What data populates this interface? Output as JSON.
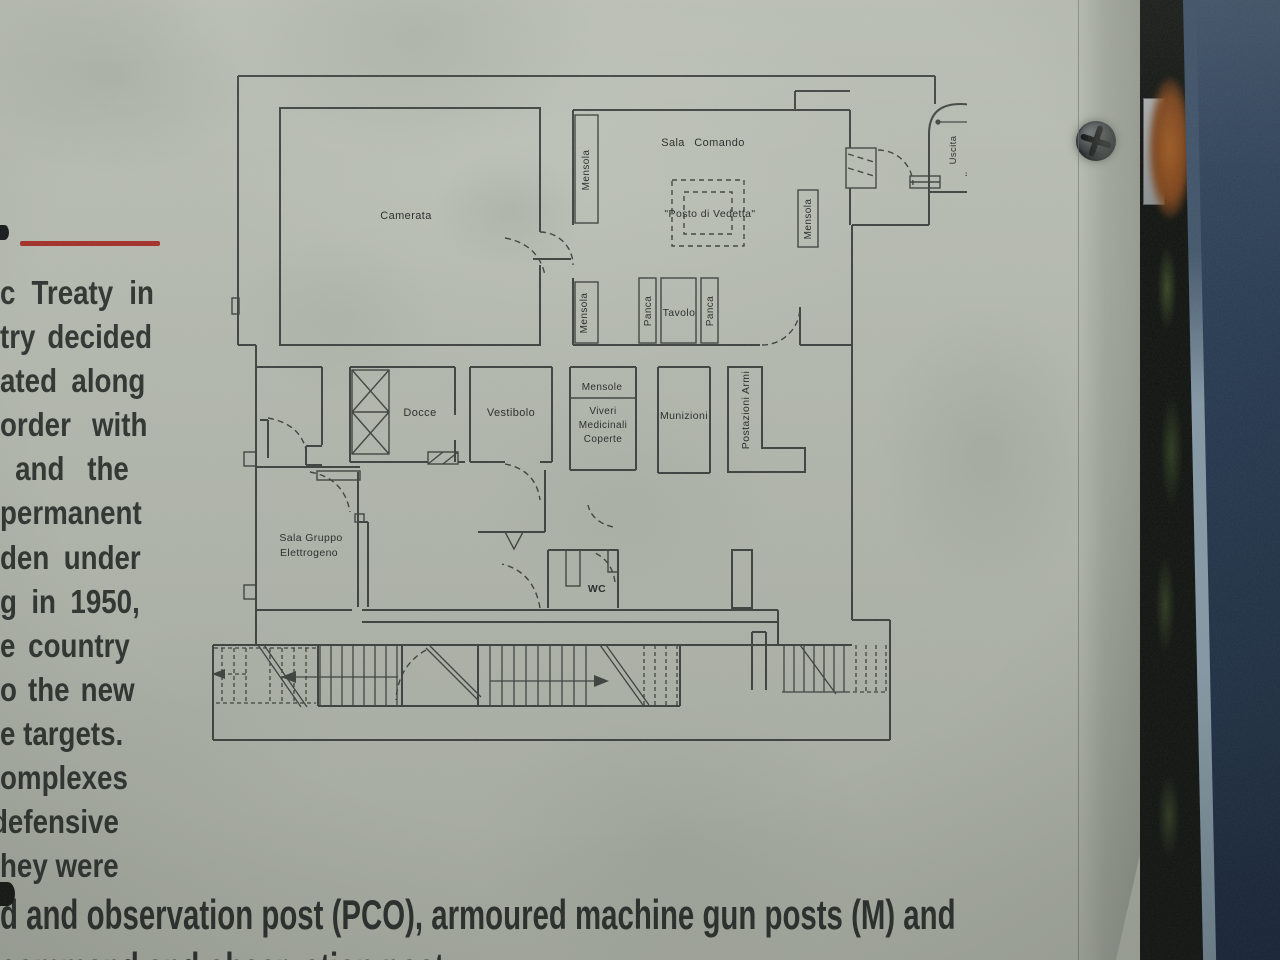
{
  "colors": {
    "panel_concrete": "#b8bdb3",
    "plan_line": "#3f4441",
    "text": "#2f3431",
    "red_rule": "#a62f28",
    "post_blue": "#283c55",
    "rust": "#8a4c1e"
  },
  "left_column": {
    "lines": [
      "c Treaty in",
      "try decided",
      "ated along",
      "order with",
      "and the",
      "permanent",
      "den under",
      "g in 1950,",
      "e country",
      "o the new",
      "e targets.",
      "omplexes",
      "defensive",
      "hey were"
    ]
  },
  "bottom": {
    "line1": "d and observation post (PCO), armoured machine gun posts (M) and",
    "line2": "command and observation post"
  },
  "floorplan": {
    "labels": {
      "camerata": "Camerata",
      "sala_comando": "Sala Comando",
      "posto_di_vedetta": "\"Posto di Vedetta\"",
      "mensola_top": "Mensola",
      "mensola_bottom": "Mensola",
      "mensola_right": "Mensola",
      "panca_left": "Panca",
      "tavolo": "Tavolo",
      "panca_right": "Panca",
      "uscita_line1": "Uscita",
      "uscita_line2": "d'emergenza",
      "docce": "Docce",
      "vestibolo": "Vestibolo",
      "mensole": "Mensole",
      "viveri_line1": "Viveri",
      "viveri_line2": "Medicinali",
      "viveri_line3": "Coperte",
      "munizioni": "Munizioni",
      "postazioni_armi": "Postazioni Armi",
      "sala_gruppo_line1": "Sala Gruppo",
      "sala_gruppo_line2": "Elettrogeno",
      "wc": "WC"
    }
  }
}
